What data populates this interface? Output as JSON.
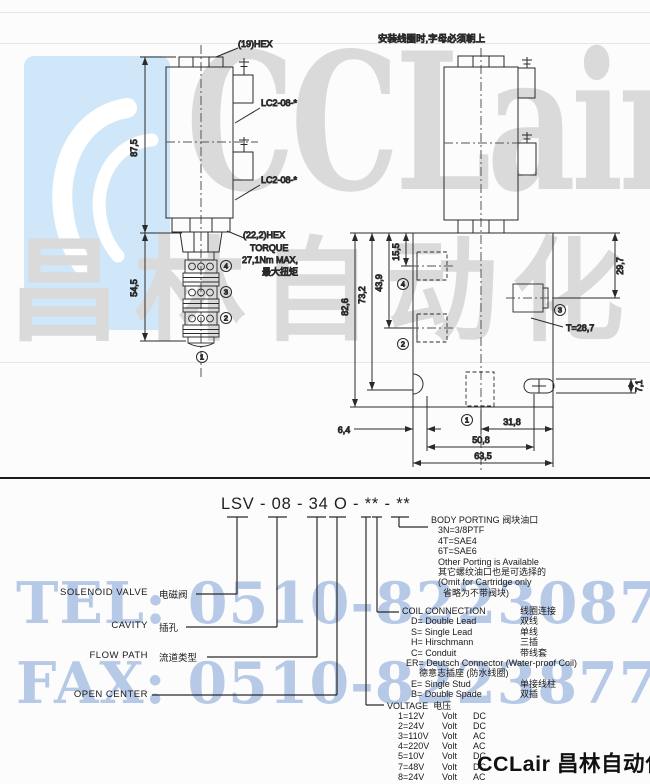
{
  "watermark": {
    "brand_latin": "CCLair",
    "brand_cn": "昌林自动化",
    "tel_line": "TEL: 0510-82230871",
    "fax_line": "FAX: 0510-82238771"
  },
  "footer": {
    "brand": "CCLair 昌林自动化"
  },
  "left_drawing": {
    "hex_top": "(19)HEX",
    "cavity_label_upper": "LC2-08-*",
    "cavity_label_lower": "LC2-08-*",
    "dim_coil_height": "87,5",
    "dim_cartridge_height": "54,5",
    "hex_lower": "(22,2)HEX",
    "torque_title": "TORQUE",
    "torque_value": "27,1Nm MAX,",
    "torque_cn": "最大扭矩",
    "port4": "4",
    "port3": "3",
    "port2": "2",
    "port1": "1"
  },
  "right_drawing": {
    "note_cn": "安装线圈时,字母必须朝上",
    "dim_82_6": "82,6",
    "dim_73_2": "73,2",
    "dim_43_9": "43,9",
    "dim_15_5": "15,5",
    "dim_29_7": "29,7",
    "thread": "T=28,7",
    "dim_7_1": "7,1",
    "dim_31_8": "31,8",
    "dim_50_8": "50,8",
    "dim_63_5": "63,5",
    "dim_6_4": "6,4",
    "port4": "4",
    "port2": "2",
    "port3": "3",
    "port1": "1"
  },
  "model_code": {
    "code": "LSV - 08 - 34  O - ** - **"
  },
  "code_labels": {
    "solenoid_en": "SOLENOID VALVE",
    "solenoid_cn": "电磁阀",
    "cavity_en": "CAVITY",
    "cavity_cn": "插孔",
    "flow_en": "FLOW PATH",
    "flow_cn": "流道类型",
    "open_center_en": "OPEN CENTER"
  },
  "body_porting": {
    "title_en": "BODY PORTING",
    "title_cn": "阀块油口",
    "opt1": "3N=3/8PTF",
    "opt2": "4T=SAE4",
    "opt3": "6T=SAE6",
    "note1": "Other Porting is Available",
    "note1_cn": "其它螺纹油口也是可选择的",
    "note2": "(Omit for Cartridge only",
    "note2_cn": "省略为不带阀块)"
  },
  "coil_connection": {
    "title_en": "COIL CONNECTION",
    "title_cn": "线圈连接",
    "rows": [
      {
        "en": "D= Double Lead",
        "cn": "双线"
      },
      {
        "en": "S= Single Lead",
        "cn": "单线"
      },
      {
        "en": "H= Hirschmann",
        "cn": "三插"
      },
      {
        "en": "C= Conduit",
        "cn": "带线套"
      }
    ],
    "er_en": "ER= Deutsch Connector (Water-proof Coil)",
    "er_cn": "德意志插座 (防水线圈)",
    "rows2": [
      {
        "en": "E= Single Stud",
        "cn": "单接线柱"
      },
      {
        "en": "B= Double Spade",
        "cn": "双插"
      }
    ]
  },
  "voltage": {
    "title_en": "VOLTAGE",
    "title_cn": "电压",
    "rows": [
      {
        "code": "1=12V",
        "unit": "Volt",
        "type": "DC"
      },
      {
        "code": "2=24V",
        "unit": "Volt",
        "type": "DC"
      },
      {
        "code": "3=110V",
        "unit": "Volt",
        "type": "AC"
      },
      {
        "code": "4=220V",
        "unit": "Volt",
        "type": "AC"
      },
      {
        "code": "5=10V",
        "unit": "Volt",
        "type": "DC"
      },
      {
        "code": "7=48V",
        "unit": "Volt",
        "type": "DC"
      },
      {
        "code": "8=24V",
        "unit": "Volt",
        "type": "AC"
      }
    ]
  }
}
